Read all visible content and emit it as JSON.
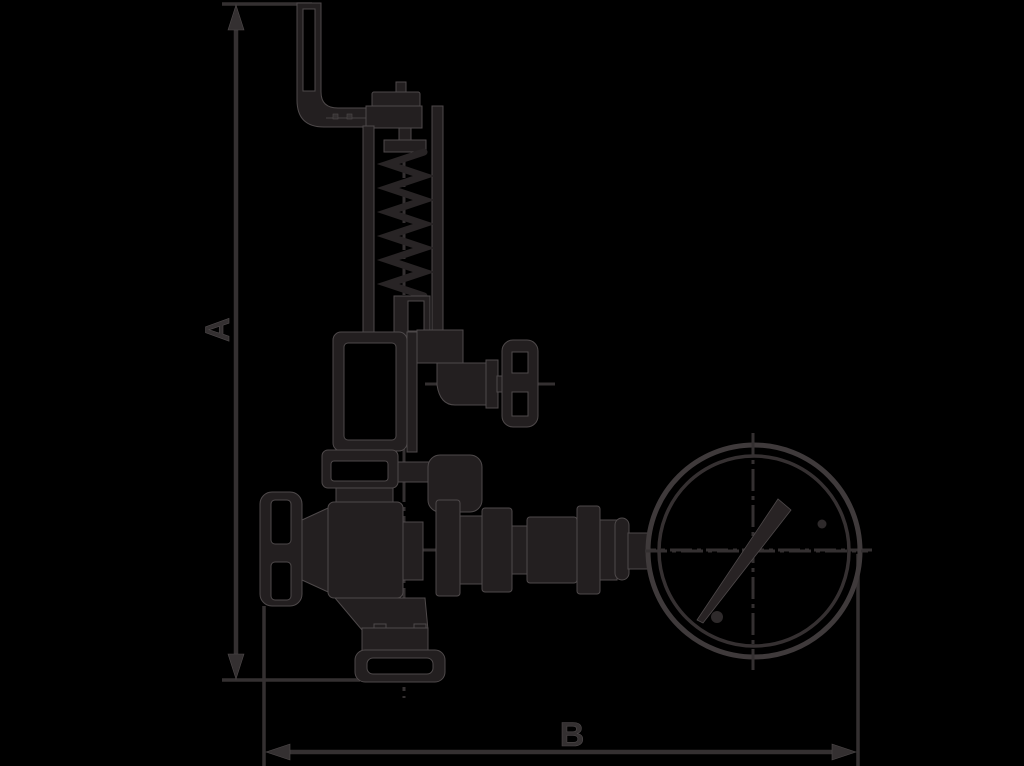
{
  "page": {
    "width": 1024,
    "height": 766,
    "background": "#000000"
  },
  "colors": {
    "background": "#000000",
    "ink": "#231f20",
    "ink_soft": "#343031",
    "edge_highlight": "#4e494a"
  },
  "drawing": {
    "kind": "technical outline drawing",
    "subject": "safety/overflow valve with lever bracket, spring bonnet, two handwheels and pressure gauge",
    "dimension_labels": {
      "a": "A",
      "b": "B"
    },
    "components": [
      "dimension-line-a",
      "dimension-line-b",
      "lever-bracket",
      "adjusting-cap",
      "spring-bonnet",
      "spring",
      "upper-valve-body",
      "outlet-neck",
      "outlet-handwheel",
      "mid-flange",
      "main-valve-body",
      "inlet-handwheel",
      "bottom-outlet",
      "bottom-flange",
      "gauge-piping",
      "pressure-gauge",
      "gauge-needle"
    ]
  }
}
